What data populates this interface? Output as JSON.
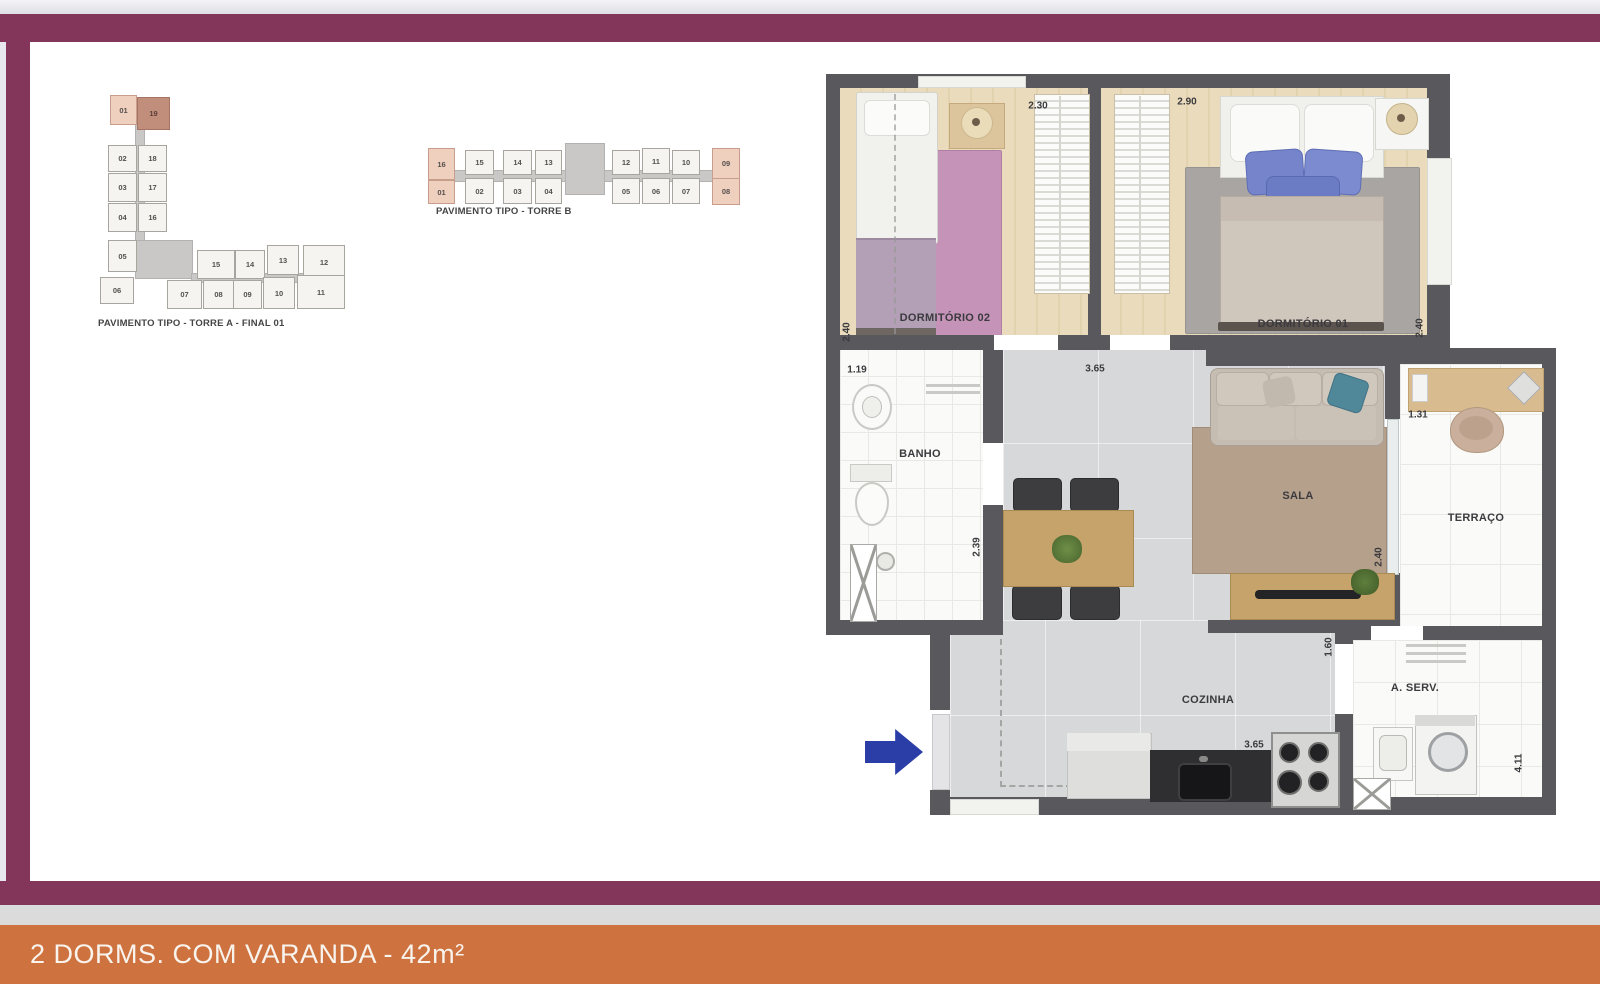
{
  "page": {
    "footer_title": "2 DORMS. COM VARANDA - 42m²"
  },
  "colors": {
    "frame_maroon": "#84365A",
    "footer_orange": "#CE7340",
    "footer_gray": "#DBDBDB",
    "wall_gray": "#59585C",
    "unit_highlight_light": "#EFCFBD",
    "unit_highlight_dark": "#C28E7C",
    "entry_arrow_blue": "#2B3EA8"
  },
  "tower_a": {
    "caption": "PAVIMENTO TIPO - TORRE A - FINAL 01",
    "units": [
      {
        "n": "01",
        "x": 14,
        "y": 5,
        "w": 25,
        "h": 28,
        "hl": "light"
      },
      {
        "n": "19",
        "x": 41,
        "y": 7,
        "w": 31,
        "h": 31,
        "hl": "dark"
      },
      {
        "n": "02",
        "x": 12,
        "y": 55,
        "w": 27,
        "h": 25
      },
      {
        "n": "18",
        "x": 42,
        "y": 55,
        "w": 27,
        "h": 25
      },
      {
        "n": "03",
        "x": 12,
        "y": 83,
        "w": 27,
        "h": 27
      },
      {
        "n": "17",
        "x": 42,
        "y": 83,
        "w": 27,
        "h": 27
      },
      {
        "n": "04",
        "x": 12,
        "y": 113,
        "w": 27,
        "h": 27
      },
      {
        "n": "16",
        "x": 42,
        "y": 113,
        "w": 27,
        "h": 27
      },
      {
        "n": "05",
        "x": 12,
        "y": 150,
        "w": 27,
        "h": 30
      },
      {
        "n": "06",
        "x": 4,
        "y": 187,
        "w": 32,
        "h": 25
      },
      {
        "n": "15",
        "x": 101,
        "y": 160,
        "w": 36,
        "h": 27
      },
      {
        "n": "14",
        "x": 139,
        "y": 160,
        "w": 28,
        "h": 27
      },
      {
        "n": "13",
        "x": 171,
        "y": 155,
        "w": 30,
        "h": 28
      },
      {
        "n": "12",
        "x": 207,
        "y": 155,
        "w": 40,
        "h": 32
      },
      {
        "n": "07",
        "x": 71,
        "y": 190,
        "w": 33,
        "h": 27
      },
      {
        "n": "08",
        "x": 107,
        "y": 190,
        "w": 29,
        "h": 27
      },
      {
        "n": "09",
        "x": 137,
        "y": 190,
        "w": 27,
        "h": 27
      },
      {
        "n": "10",
        "x": 167,
        "y": 187,
        "w": 30,
        "h": 30
      },
      {
        "n": "11",
        "x": 201,
        "y": 185,
        "w": 46,
        "h": 32
      }
    ]
  },
  "tower_b": {
    "caption": "PAVIMENTO TIPO - TORRE B",
    "units": [
      {
        "n": "16",
        "x": 4,
        "y": 12,
        "w": 25,
        "h": 30,
        "hl": "light"
      },
      {
        "n": "01",
        "x": 4,
        "y": 44,
        "w": 25,
        "h": 22,
        "hl": "light"
      },
      {
        "n": "15",
        "x": 41,
        "y": 14,
        "w": 27,
        "h": 23
      },
      {
        "n": "02",
        "x": 41,
        "y": 42,
        "w": 27,
        "h": 24
      },
      {
        "n": "14",
        "x": 79,
        "y": 14,
        "w": 27,
        "h": 23
      },
      {
        "n": "03",
        "x": 79,
        "y": 42,
        "w": 27,
        "h": 24
      },
      {
        "n": "13",
        "x": 111,
        "y": 14,
        "w": 25,
        "h": 23
      },
      {
        "n": "04",
        "x": 111,
        "y": 42,
        "w": 25,
        "h": 24
      },
      {
        "n": "12",
        "x": 188,
        "y": 14,
        "w": 26,
        "h": 23
      },
      {
        "n": "05",
        "x": 188,
        "y": 42,
        "w": 26,
        "h": 24
      },
      {
        "n": "11",
        "x": 218,
        "y": 12,
        "w": 26,
        "h": 24
      },
      {
        "n": "06",
        "x": 218,
        "y": 42,
        "w": 26,
        "h": 24
      },
      {
        "n": "10",
        "x": 248,
        "y": 14,
        "w": 26,
        "h": 23
      },
      {
        "n": "07",
        "x": 248,
        "y": 42,
        "w": 26,
        "h": 24
      },
      {
        "n": "09",
        "x": 288,
        "y": 12,
        "w": 26,
        "h": 29,
        "hl": "light"
      },
      {
        "n": "08",
        "x": 288,
        "y": 42,
        "w": 26,
        "h": 25,
        "hl": "light"
      }
    ]
  },
  "floor_plan": {
    "room_labels": [
      {
        "t": "DORMITÓRIO 02",
        "x": 119,
        "y": 252
      },
      {
        "t": "DORMITÓRIO 01",
        "x": 477,
        "y": 258
      },
      {
        "t": "BANHO",
        "x": 94,
        "y": 388
      },
      {
        "t": "SALA",
        "x": 472,
        "y": 430
      },
      {
        "t": "TERRAÇO",
        "x": 650,
        "y": 452
      },
      {
        "t": "COZINHA",
        "x": 382,
        "y": 634
      },
      {
        "t": "A. SERV.",
        "x": 589,
        "y": 622
      }
    ],
    "dimensions": [
      {
        "t": "2.30",
        "x": 212,
        "y": 40,
        "v": 0
      },
      {
        "t": "2.90",
        "x": 361,
        "y": 36,
        "v": 0
      },
      {
        "t": "2.40",
        "x": 21,
        "y": 266,
        "v": 1
      },
      {
        "t": "2.40",
        "x": 594,
        "y": 262,
        "v": 1
      },
      {
        "t": "1.19",
        "x": 31,
        "y": 304,
        "v": 0
      },
      {
        "t": "3.65",
        "x": 269,
        "y": 303,
        "v": 0
      },
      {
        "t": "1.31",
        "x": 592,
        "y": 349,
        "v": 0
      },
      {
        "t": "2.39",
        "x": 151,
        "y": 481,
        "v": 1
      },
      {
        "t": "2.40",
        "x": 553,
        "y": 491,
        "v": 1
      },
      {
        "t": "1.60",
        "x": 503,
        "y": 581,
        "v": 1
      },
      {
        "t": "3.65",
        "x": 428,
        "y": 679,
        "v": 0
      },
      {
        "t": "4.11",
        "x": 693,
        "y": 697,
        "v": 1
      }
    ]
  }
}
